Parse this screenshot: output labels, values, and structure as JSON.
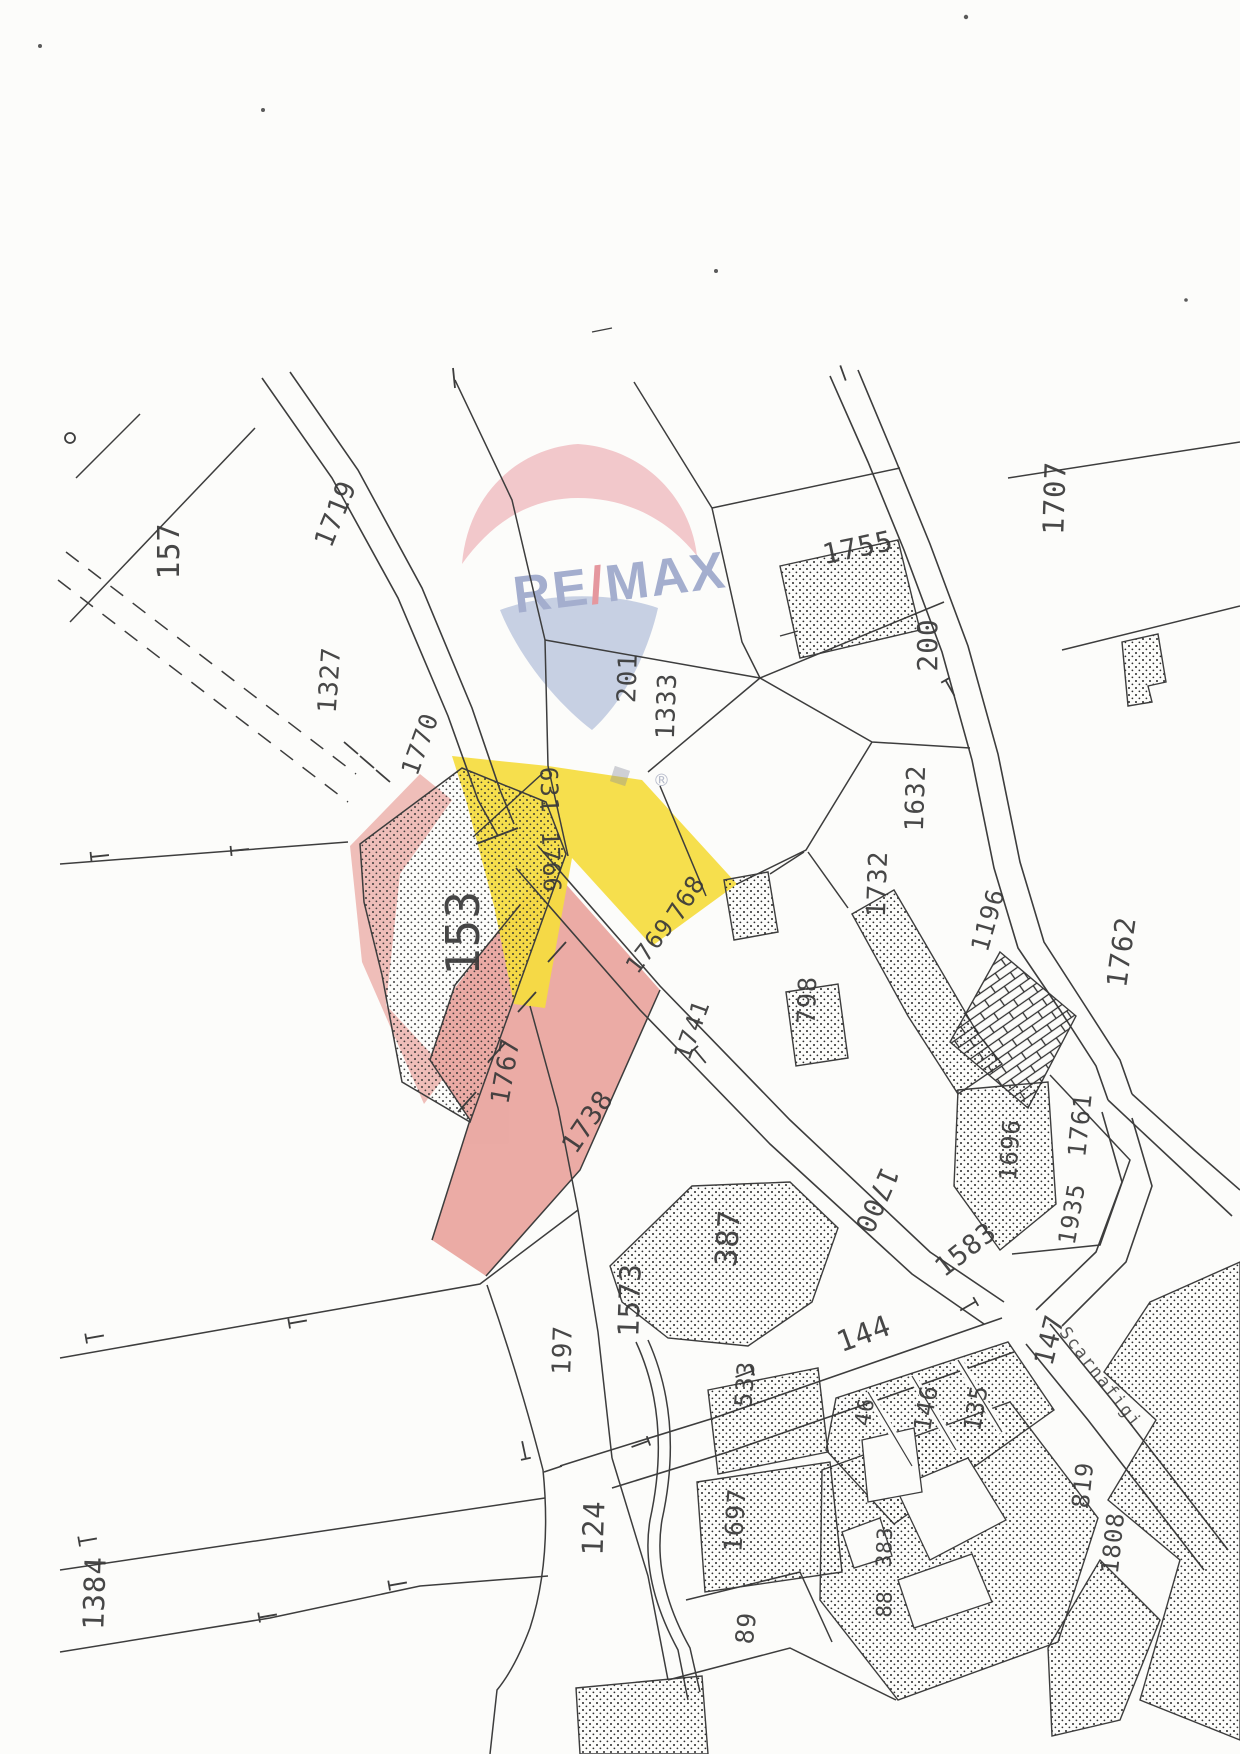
{
  "colors": {
    "paper": "#fcfcfa",
    "line": "#3d3d3d",
    "label": "#3a3a3a",
    "highlight_yellow": "#f5dc3e",
    "highlight_pink": "#e9a29b",
    "wm_red": "#efb6bb",
    "wm_blue": "#b9c4dd",
    "wm_text": "#99a4c9",
    "wm_slash": "#e28a92",
    "wm_basket": "#8a8f9e"
  },
  "watermark": {
    "brand_left": "RE",
    "brand_slash": "/",
    "brand_right": "MAX",
    "registered": "®"
  },
  "map": {
    "street_name": "Scarnafigi",
    "highlighted_parcels": {
      "yellow_labels": [
        "631",
        "1766",
        "768"
      ],
      "pink_labels": [
        "1738"
      ]
    },
    "labels": [
      {
        "t": "157",
        "x": 170,
        "y": 551,
        "r": -90,
        "s": 30
      },
      {
        "t": "1719",
        "x": 336,
        "y": 514,
        "r": -68,
        "s": 27
      },
      {
        "t": "1707",
        "x": 1055,
        "y": 498,
        "r": -88,
        "s": 29
      },
      {
        "t": "1755",
        "x": 858,
        "y": 548,
        "r": -12,
        "s": 28
      },
      {
        "t": "201",
        "x": 628,
        "y": 678,
        "r": -88,
        "s": 26
      },
      {
        "t": "1333",
        "x": 667,
        "y": 706,
        "r": -88,
        "s": 26
      },
      {
        "t": "200",
        "x": 928,
        "y": 645,
        "r": -90,
        "s": 28
      },
      {
        "t": "1327",
        "x": 330,
        "y": 680,
        "r": -86,
        "s": 26
      },
      {
        "t": "1770",
        "x": 420,
        "y": 744,
        "r": -70,
        "s": 25
      },
      {
        "t": "631",
        "x": 549,
        "y": 790,
        "r": 88,
        "s": 24
      },
      {
        "t": "1766",
        "x": 551,
        "y": 862,
        "r": 88,
        "s": 24
      },
      {
        "t": "153",
        "x": 463,
        "y": 933,
        "r": -90,
        "s": 46
      },
      {
        "t": "768",
        "x": 686,
        "y": 898,
        "r": -58,
        "s": 25
      },
      {
        "t": "1769",
        "x": 650,
        "y": 946,
        "r": -52,
        "s": 24
      },
      {
        "t": "1741",
        "x": 692,
        "y": 1030,
        "r": -70,
        "s": 24
      },
      {
        "t": "798",
        "x": 807,
        "y": 1000,
        "r": -88,
        "s": 25
      },
      {
        "t": "1632",
        "x": 916,
        "y": 798,
        "r": -88,
        "s": 26
      },
      {
        "t": "1732",
        "x": 878,
        "y": 884,
        "r": -88,
        "s": 26
      },
      {
        "t": "1196",
        "x": 988,
        "y": 920,
        "r": -74,
        "s": 25
      },
      {
        "t": "1762",
        "x": 1122,
        "y": 952,
        "r": -82,
        "s": 28
      },
      {
        "t": "1761",
        "x": 1080,
        "y": 1125,
        "r": -84,
        "s": 25
      },
      {
        "t": "1696",
        "x": 1010,
        "y": 1150,
        "r": -86,
        "s": 24
      },
      {
        "t": "1935",
        "x": 1072,
        "y": 1214,
        "r": -80,
        "s": 24
      },
      {
        "t": "1767",
        "x": 506,
        "y": 1071,
        "r": -80,
        "s": 26
      },
      {
        "t": "1738",
        "x": 588,
        "y": 1122,
        "r": -56,
        "s": 27
      },
      {
        "t": "387",
        "x": 729,
        "y": 1238,
        "r": -86,
        "s": 30
      },
      {
        "t": "1700",
        "x": 876,
        "y": 1200,
        "r": 114,
        "s": 27
      },
      {
        "t": "1583",
        "x": 966,
        "y": 1250,
        "r": -38,
        "s": 27
      },
      {
        "t": "144",
        "x": 864,
        "y": 1334,
        "r": -20,
        "s": 29
      },
      {
        "t": "147",
        "x": 1050,
        "y": 1340,
        "r": -76,
        "s": 27
      },
      {
        "t": "46",
        "x": 866,
        "y": 1412,
        "r": -80,
        "s": 22
      },
      {
        "t": "146",
        "x": 926,
        "y": 1408,
        "r": -80,
        "s": 24
      },
      {
        "t": "135",
        "x": 976,
        "y": 1408,
        "r": -80,
        "s": 24
      },
      {
        "t": "1573",
        "x": 630,
        "y": 1300,
        "r": -88,
        "s": 29
      },
      {
        "t": "197",
        "x": 563,
        "y": 1350,
        "r": -88,
        "s": 26
      },
      {
        "t": "124",
        "x": 594,
        "y": 1528,
        "r": -88,
        "s": 29
      },
      {
        "t": "1384",
        "x": 95,
        "y": 1593,
        "r": -88,
        "s": 29
      },
      {
        "t": "89",
        "x": 746,
        "y": 1628,
        "r": -84,
        "s": 25
      },
      {
        "t": "1697",
        "x": 735,
        "y": 1520,
        "r": -86,
        "s": 25
      },
      {
        "t": "533",
        "x": 745,
        "y": 1384,
        "r": -86,
        "s": 24
      },
      {
        "t": "819",
        "x": 1083,
        "y": 1485,
        "r": -84,
        "s": 24
      },
      {
        "t": "1808",
        "x": 1113,
        "y": 1543,
        "r": -84,
        "s": 24
      },
      {
        "t": "383",
        "x": 885,
        "y": 1547,
        "r": -88,
        "s": 21
      },
      {
        "t": "88",
        "x": 885,
        "y": 1604,
        "r": -88,
        "s": 21
      },
      {
        "t": "Scarnafigi",
        "x": 1100,
        "y": 1378,
        "r": 52,
        "s": 17,
        "k": "street"
      }
    ]
  }
}
